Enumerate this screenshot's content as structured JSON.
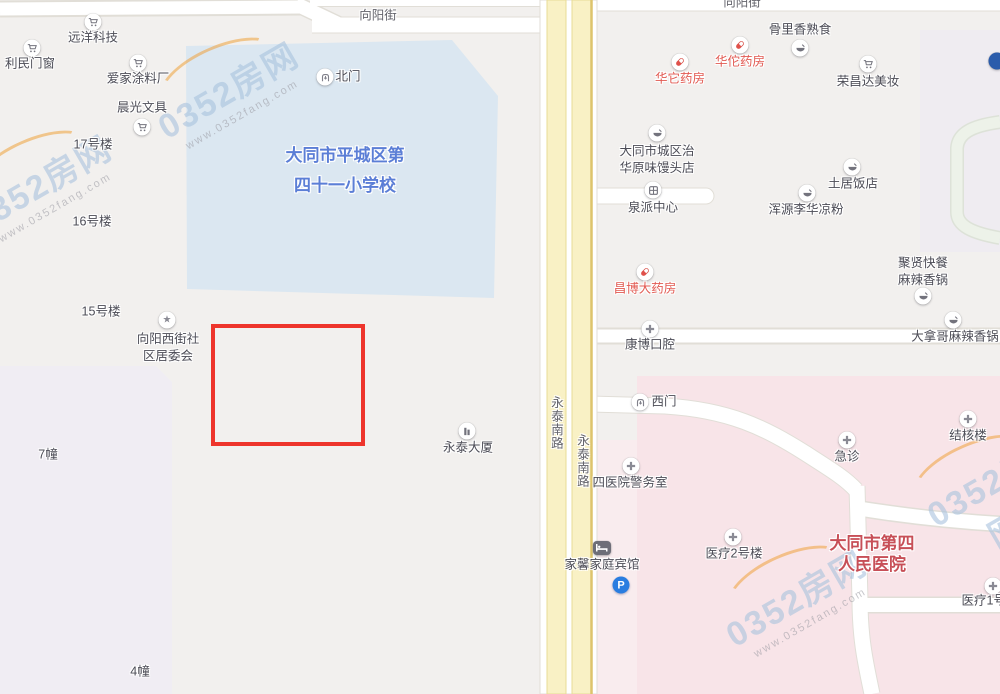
{
  "map": {
    "watermark": {
      "brand": "0352房网",
      "url": "www.0352fang.com"
    },
    "colors": {
      "bg": "#f2f0ee",
      "school_fill": "#dbe7f1",
      "school_text": "#5b7ed6",
      "hospital_fill": "#f8e4e8",
      "hospital_fill_light": "#f9ecee",
      "hospital_text": "#c74f57",
      "residential_fill": "#f0edf3",
      "block_fill": "#efecf1",
      "road_fill": "#ffffff",
      "road_border": "#e1ded7",
      "yellow_fill": "#f9f1c5",
      "yellow_border": "#e8dc96",
      "yellow_edge": "#ddc46c",
      "loop_fill": "#edf2e9",
      "loop_border": "#dde2d8",
      "label_text": "#4c4c56",
      "red_text": "#e25a52",
      "highlight_red": "#ee352c",
      "wm_blue": "#a9c3de",
      "wm_orange": "#f0a23c",
      "icon_gray": "#73737d",
      "parking_blue": "#2a7de0",
      "dot_blue": "#2b5cab"
    },
    "area_labels": [
      {
        "id": "school-label",
        "class": "school",
        "lines": [
          "大同市平城区第",
          "四十一小学校"
        ],
        "x": 345,
        "y": 171
      },
      {
        "id": "hospital-label",
        "class": "hospital",
        "lines": [
          "大同市第四",
          "人民医院"
        ],
        "x": 872,
        "y": 554
      }
    ],
    "road_labels": [
      {
        "id": "xiangyang-street-west",
        "label": "向阳街",
        "x": 378,
        "y": 16
      },
      {
        "id": "xiangyang-street-east",
        "label": "向阳街",
        "x": 742,
        "y": 3
      },
      {
        "id": "yongtai-south-road-1",
        "label": "永泰南路",
        "x": 556,
        "y": 423,
        "vertical": true
      },
      {
        "id": "yongtai-south-road-2",
        "label": "永泰南路",
        "x": 582,
        "y": 461,
        "vertical": true
      }
    ],
    "highlight_box": {
      "x": 211,
      "y": 324,
      "w": 146,
      "h": 114
    },
    "pois": [
      {
        "id": "yuanyang-tech",
        "icon": "cart",
        "ix": 93,
        "iy": 22,
        "label": "远洋科技",
        "x": 93,
        "y": 38
      },
      {
        "id": "limin-doors",
        "icon": "cart",
        "ix": 32,
        "iy": 48,
        "label": "利民门窗",
        "x": 30,
        "y": 64
      },
      {
        "id": "aijia-paint",
        "icon": "cart",
        "ix": 138,
        "iy": 63,
        "label": "爱家涂料厂",
        "x": 138,
        "y": 79
      },
      {
        "id": "chenguang-stationery",
        "icon": "cart",
        "ix": 142,
        "iy": 127,
        "label": "晨光文具",
        "x": 142,
        "y": 108
      },
      {
        "id": "building-17",
        "label": "17号楼",
        "x": 93,
        "y": 145
      },
      {
        "id": "building-16",
        "label": "16号楼",
        "x": 92,
        "y": 222
      },
      {
        "id": "building-15",
        "label": "15号楼",
        "x": 101,
        "y": 312
      },
      {
        "id": "xiangyang-west-committee",
        "icon": "star",
        "ix": 167,
        "iy": 320,
        "lines": [
          "向阳西街社",
          "区居委会"
        ],
        "x": 168,
        "y": 348
      },
      {
        "id": "building-7",
        "label": "7幢",
        "x": 48,
        "y": 455
      },
      {
        "id": "building-4",
        "label": "4幢",
        "x": 140,
        "y": 672
      },
      {
        "id": "north-gate",
        "icon": "gate",
        "ix": 325,
        "iy": 77,
        "label": "北门",
        "x": 348,
        "y": 77
      },
      {
        "id": "yongtai-tower",
        "icon": "building",
        "ix": 467,
        "iy": 431,
        "label": "永泰大厦",
        "x": 468,
        "y": 448
      },
      {
        "id": "huata-pharmacy",
        "icon": "capsule",
        "ix": 680,
        "iy": 62,
        "label": "华它药房",
        "x": 680,
        "y": 79,
        "color": "red"
      },
      {
        "id": "huatuo-pharmacy",
        "icon": "capsule",
        "ix": 740,
        "iy": 45,
        "label": "华佗药房",
        "x": 740,
        "y": 62,
        "color": "red"
      },
      {
        "id": "gulixiang-deli",
        "icon": "food",
        "ix": 800,
        "iy": 48,
        "label": "骨里香熟食",
        "x": 800,
        "y": 30
      },
      {
        "id": "rongchangda-beauty",
        "icon": "cart",
        "ix": 868,
        "iy": 64,
        "label": "荣昌达美妆",
        "x": 868,
        "y": 82
      },
      {
        "id": "mantou-shop",
        "icon": "food",
        "ix": 657,
        "iy": 133,
        "lines": [
          "大同市城区治",
          "华原味馒头店"
        ],
        "x": 657,
        "y": 160
      },
      {
        "id": "quanpai-center",
        "icon": "storefront",
        "ix": 653,
        "iy": 190,
        "label": "泉派中心",
        "x": 653,
        "y": 208
      },
      {
        "id": "tuju-restaurant",
        "icon": "food",
        "ix": 852,
        "iy": 167,
        "label": "土居饭店",
        "x": 853,
        "y": 184
      },
      {
        "id": "hunyuan-liangfen",
        "icon": "food",
        "ix": 807,
        "iy": 193,
        "label": "浑源李华凉粉",
        "x": 806,
        "y": 210
      },
      {
        "id": "juxian-restaurant",
        "icon": "food",
        "ix": 923,
        "iy": 296,
        "lines": [
          "聚贤快餐",
          "麻辣香锅"
        ],
        "x": 923,
        "y": 272
      },
      {
        "id": "changbo-pharmacy",
        "icon": "capsule",
        "ix": 645,
        "iy": 272,
        "label": "昌博大药房",
        "x": 645,
        "y": 289,
        "color": "red"
      },
      {
        "id": "kangbo-dental",
        "icon": "cross",
        "ix": 650,
        "iy": 329,
        "label": "康博口腔",
        "x": 650,
        "y": 345
      },
      {
        "id": "danage-malaxiangguo",
        "icon": "food",
        "ix": 953,
        "iy": 320,
        "label": "大拿哥麻辣香锅",
        "x": 955,
        "y": 337
      },
      {
        "id": "west-gate",
        "icon": "gate",
        "ix": 640,
        "iy": 402,
        "label": "西门",
        "x": 664,
        "y": 402
      },
      {
        "id": "emergency",
        "icon": "cross",
        "ix": 847,
        "iy": 440,
        "label": "急诊",
        "x": 847,
        "y": 457
      },
      {
        "id": "tuberculosis-building",
        "icon": "cross",
        "ix": 968,
        "iy": 419,
        "label": "结核楼",
        "x": 968,
        "y": 436
      },
      {
        "id": "hospital-police-office",
        "icon": "cross",
        "ix": 631,
        "iy": 466,
        "label": "四医院警务室",
        "x": 630,
        "y": 483
      },
      {
        "id": "medical-building-2",
        "icon": "cross",
        "ix": 733,
        "iy": 537,
        "label": "医疗2号楼",
        "x": 734,
        "y": 554
      },
      {
        "id": "jiaxin-family-hotel",
        "icon": "bed",
        "ix": 602,
        "iy": 548,
        "label": "家馨家庭宾馆",
        "x": 602,
        "y": 565
      },
      {
        "id": "parking",
        "icon": "parking",
        "ix": 621,
        "iy": 585
      },
      {
        "id": "medical-building-1",
        "icon": "cross",
        "ix": 993,
        "iy": 586,
        "label": "医疗1号楼",
        "x": 990,
        "y": 601
      },
      {
        "id": "edge-poi",
        "icon": "dot",
        "ix": 997,
        "iy": 61
      }
    ]
  }
}
